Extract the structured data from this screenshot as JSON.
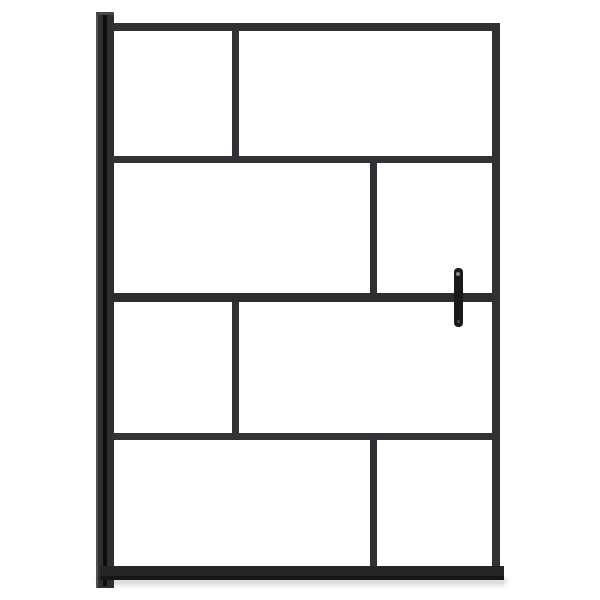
{
  "image": {
    "subject": "walk-in shower screen: black metal frame with brick-pattern clear glass panes, left wall mounting profile and vertical grab handle on the right",
    "background_color": "#ffffff",
    "frame_color": "#303134",
    "frame_color_dark": "#242527",
    "handle_color": "#18191a",
    "shadow_color": "#bdbdbd"
  },
  "scene": {
    "width": 600,
    "height": 600,
    "members": [
      {
        "name": "floor-shadow",
        "x": 98,
        "y": 578,
        "w": 408,
        "h": 7,
        "color": "#bdbdbd",
        "blur": 2.5,
        "opacity": 0.6
      },
      {
        "name": "wall-profile",
        "x": 96,
        "y": 12,
        "w": 18,
        "h": 576,
        "color": "#2d2e30"
      },
      {
        "name": "wall-profile-left-highlight",
        "x": 96,
        "y": 12,
        "w": 2,
        "h": 576,
        "color": "#585858",
        "opacity": 0.9
      },
      {
        "name": "wall-profile-top-cap",
        "x": 96,
        "y": 12,
        "w": 18,
        "h": 3,
        "color": "#47484a"
      },
      {
        "name": "wall-profile-seam",
        "x": 103,
        "y": 15,
        "w": 4,
        "h": 571,
        "color": "#0e0e0f"
      },
      {
        "name": "top-rail",
        "x": 112,
        "y": 23,
        "w": 388,
        "h": 8,
        "color": "#303134"
      },
      {
        "name": "right-stile",
        "x": 492,
        "y": 23,
        "w": 8,
        "h": 557,
        "color": "#303134"
      },
      {
        "name": "bottom-rail",
        "x": 100,
        "y": 566,
        "w": 404,
        "h": 14,
        "color": "#242527"
      },
      {
        "name": "bottom-rail-seal",
        "x": 100,
        "y": 576,
        "w": 404,
        "h": 4,
        "color": "#151617"
      },
      {
        "name": "horizontal-rail-1",
        "x": 112,
        "y": 156,
        "w": 380,
        "h": 7,
        "color": "#323336"
      },
      {
        "name": "horizontal-rail-2",
        "x": 112,
        "y": 293,
        "w": 380,
        "h": 9,
        "color": "#2c2d2f"
      },
      {
        "name": "horizontal-rail-3",
        "x": 112,
        "y": 433,
        "w": 380,
        "h": 7,
        "color": "#323336"
      },
      {
        "name": "pane-divider-row1",
        "x": 232,
        "y": 31,
        "w": 7,
        "h": 125,
        "color": "#303134"
      },
      {
        "name": "pane-divider-row2",
        "x": 370,
        "y": 163,
        "w": 7,
        "h": 130,
        "color": "#303134"
      },
      {
        "name": "pane-divider-row3",
        "x": 232,
        "y": 302,
        "w": 7,
        "h": 131,
        "color": "#303134"
      },
      {
        "name": "pane-divider-row4",
        "x": 370,
        "y": 440,
        "w": 7,
        "h": 126,
        "color": "#303134"
      },
      {
        "name": "grab-handle",
        "x": 454,
        "y": 268,
        "w": 9,
        "h": 59,
        "color": "#18191a",
        "radius": 4
      },
      {
        "name": "handle-screw-top",
        "x": 456,
        "y": 272,
        "w": 4,
        "h": 4,
        "color": "#888888",
        "radius": 2
      },
      {
        "name": "handle-screw-bottom",
        "x": 457,
        "y": 320,
        "w": 3,
        "h": 3,
        "color": "#4a4a4c",
        "radius": 2
      }
    ]
  }
}
